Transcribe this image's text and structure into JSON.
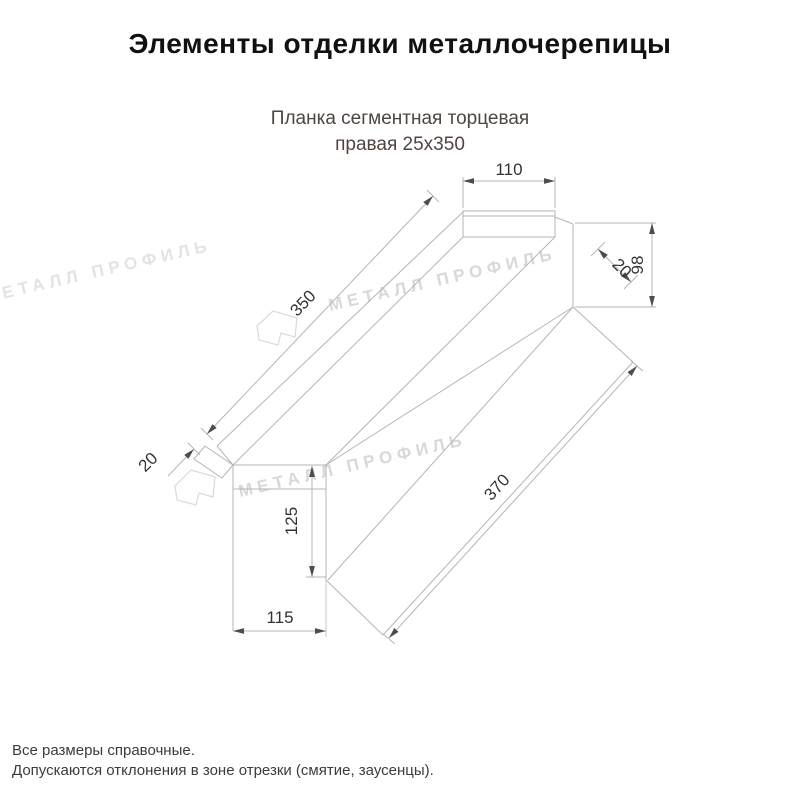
{
  "header": {
    "title": "Элементы отделки металлочерепицы"
  },
  "product": {
    "name_line1": "Планка сегментная торцевая",
    "name_line2": "правая 25х350"
  },
  "drawing": {
    "type": "dimensioned technical drawing of segmental end strip",
    "dimensions": {
      "top_width": "110",
      "right_height": "98",
      "right_hem": "20",
      "upper_length": "350",
      "left_hem": "20",
      "left_rect_height": "125",
      "left_rect_width": "115",
      "lower_length": "370"
    },
    "line_color": "#b5b5b5",
    "dim_text_color": "#333333",
    "arrow_color": "#4d4d4d"
  },
  "watermark": {
    "text": "МЕТАЛЛ ПРОФИЛЬ",
    "logo": "metall-profil-logo",
    "color": "#d8d8d8"
  },
  "footer": {
    "note1": "Все размеры справочные.",
    "note2": "Допускаются отклонения в зоне отрезки (смятие, заусенцы)."
  }
}
